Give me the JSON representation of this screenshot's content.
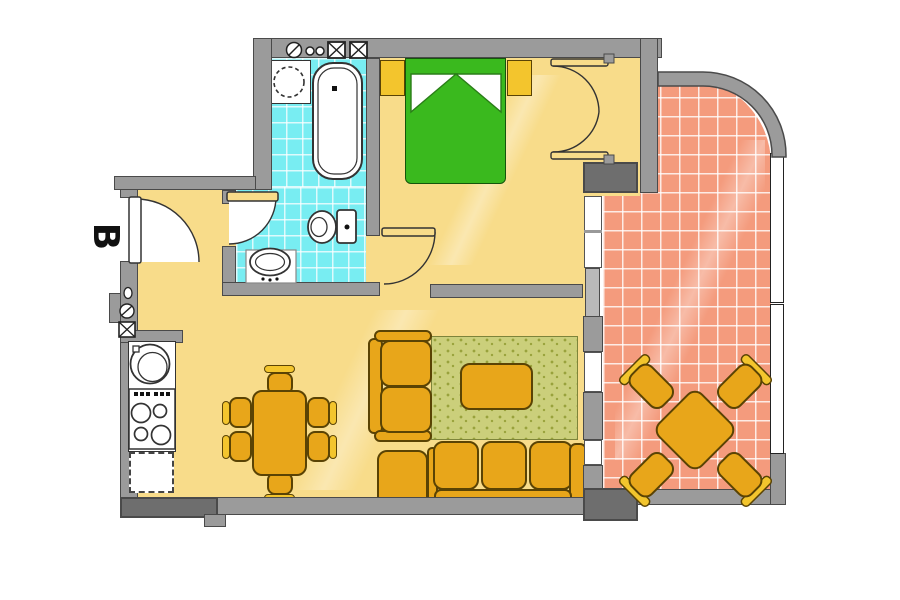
{
  "label": {
    "unit": "B"
  },
  "colors": {
    "wall": "#9b9b9b",
    "wall_dark": "#6e6e6e",
    "outline": "#4a4a4a",
    "floor": "#F8DC8A",
    "bath_tile": "#78EDF2",
    "terrace_tile": "#F49B7D",
    "furniture": "#E8A61A",
    "furniture_light": "#F3C52D",
    "furniture_outline": "#5a4304",
    "bed": "#3AB91E",
    "rug": "#CBCF7B"
  },
  "rooms": [
    {
      "name": "hallway",
      "floor": "yellow"
    },
    {
      "name": "bathroom",
      "floor": "cyan-tile",
      "fixtures": [
        "washing-machine",
        "bathtub",
        "toilet",
        "pedestal-sink"
      ]
    },
    {
      "name": "bedroom",
      "floor": "yellow",
      "furniture": [
        "double-bed",
        "two-pillows",
        "nightstand-left",
        "nightstand-right",
        "wardrobe-double-doors"
      ]
    },
    {
      "name": "kitchen-living-room",
      "floor": "yellow",
      "furniture": [
        "round-sink",
        "stove-4-burners",
        "dashed-counter",
        "dining-table",
        "six-dining-chairs",
        "loveseat",
        "ottoman",
        "rug",
        "coffee-table",
        "three-seat-sofa"
      ]
    },
    {
      "name": "terrace",
      "floor": "salmon-tile",
      "furniture": [
        "square-table-rotated-45",
        "four-chairs"
      ]
    }
  ],
  "openings": [
    "entrance-door",
    "bathroom-door",
    "bedroom-door",
    "balcony-door",
    "three-windows",
    "terrace-railing"
  ],
  "utility_symbols": [
    "vent-circle-top",
    "two-outlets-top",
    "two-shaft-boxes-top",
    "peephole-left",
    "vent-circle-left",
    "shaft-box-left"
  ]
}
